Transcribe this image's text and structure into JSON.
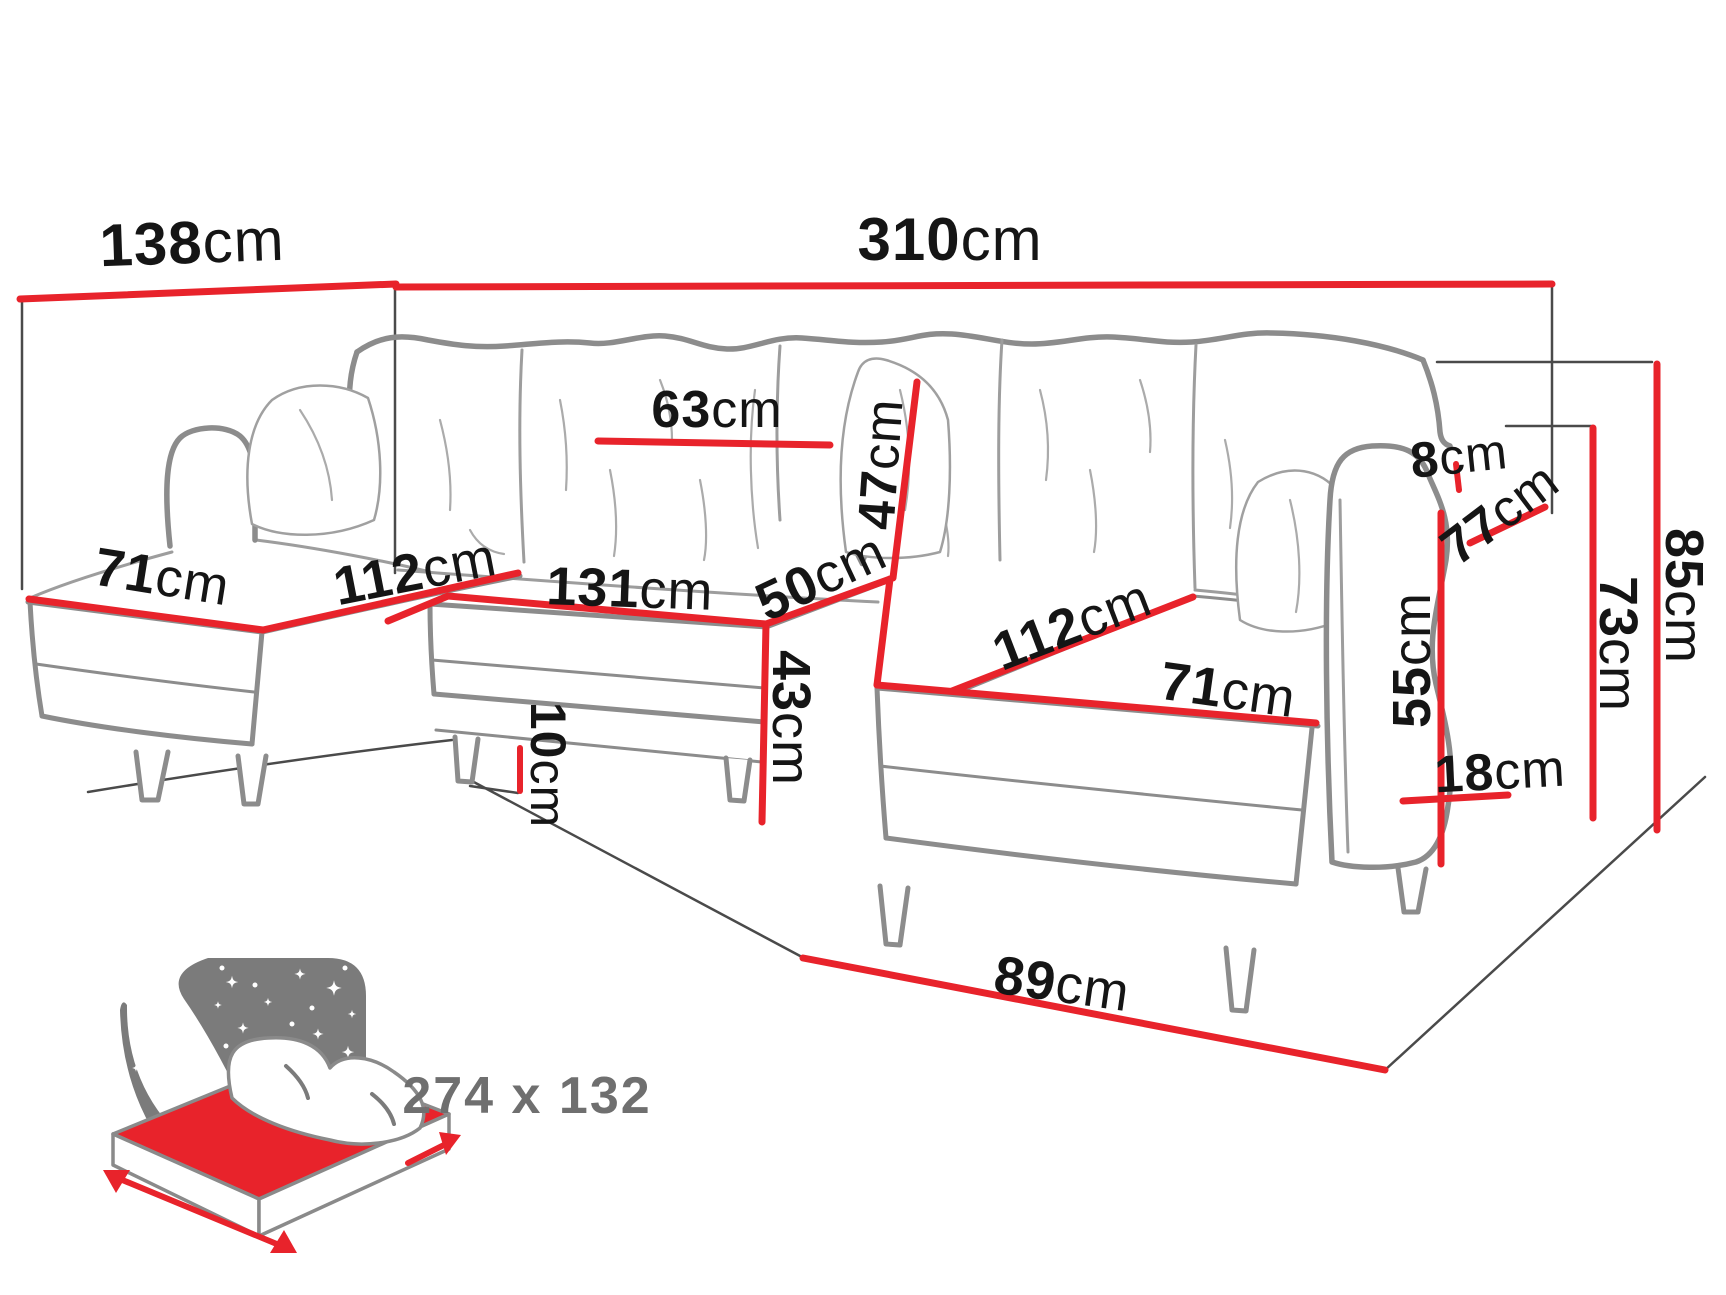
{
  "diagram": {
    "type": "sofa-dimension-diagram",
    "background_color": "#ffffff",
    "accent_color": "#e8232b",
    "outline_color": "#8c8c8c",
    "label_color": "#151515",
    "sleeping_label_color": "#6f6f6f",
    "dimensions": [
      {
        "id": "left-side-depth",
        "value": "138",
        "unit": "cm"
      },
      {
        "id": "total-width",
        "value": "310",
        "unit": "cm"
      },
      {
        "id": "back-cushion-width",
        "value": "63",
        "unit": "cm"
      },
      {
        "id": "backrest-cushion-height",
        "value": "47",
        "unit": "cm"
      },
      {
        "id": "armrest-gap",
        "value": "8",
        "unit": "cm"
      },
      {
        "id": "armrest-depth",
        "value": "77",
        "unit": "cm"
      },
      {
        "id": "left-chaise-width",
        "value": "71",
        "unit": "cm"
      },
      {
        "id": "left-chaise-length",
        "value": "112",
        "unit": "cm"
      },
      {
        "id": "middle-seat-width",
        "value": "131",
        "unit": "cm"
      },
      {
        "id": "seat-depth",
        "value": "50",
        "unit": "cm"
      },
      {
        "id": "seat-height",
        "value": "43",
        "unit": "cm"
      },
      {
        "id": "leg-height",
        "value": "10",
        "unit": "cm"
      },
      {
        "id": "right-chaise-length",
        "value": "112",
        "unit": "cm"
      },
      {
        "id": "right-chaise-width",
        "value": "71",
        "unit": "cm"
      },
      {
        "id": "armrest-height-from-seat",
        "value": "55",
        "unit": "cm"
      },
      {
        "id": "armrest-width",
        "value": "18",
        "unit": "cm"
      },
      {
        "id": "armrest-height",
        "value": "73",
        "unit": "cm"
      },
      {
        "id": "total-height",
        "value": "85",
        "unit": "cm"
      },
      {
        "id": "right-chaise-front-depth",
        "value": "89",
        "unit": "cm"
      }
    ],
    "sleeping_area": {
      "icon": "sleeping-bed-icon",
      "value": "274 x 132"
    }
  }
}
